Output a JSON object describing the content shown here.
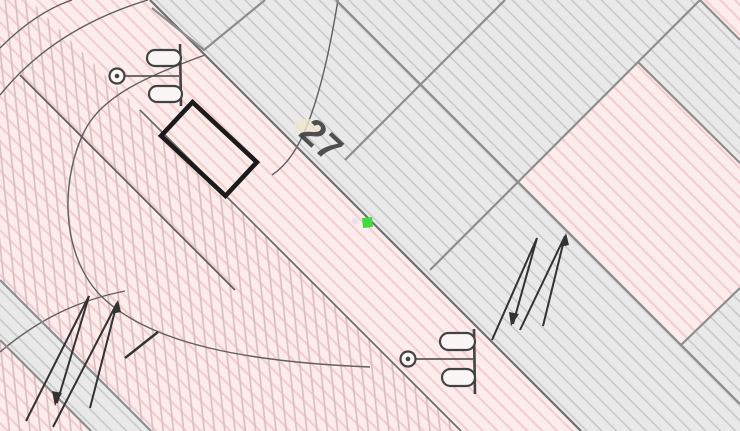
{
  "map_view": {
    "type": "cadastral-map-excerpt",
    "parcel_label": "27",
    "marker": {
      "type": "location-marker",
      "shape": "small-square",
      "color": "#3fdc3f"
    },
    "selection": {
      "type": "selected-building-outline",
      "shape": "rotated-rectangle",
      "color": "#1b1b1b"
    },
    "symbols": [
      {
        "name": "street-lamp-symbol",
        "count": 2
      },
      {
        "name": "slope-arrows-symbol",
        "count": 2
      }
    ],
    "colors": {
      "pink_bg": "#fdecec",
      "pink_hatch": "#f1cdce",
      "crosshatch_line": "#d9bec3",
      "gray_bg": "#e9e9e9",
      "gray_hatch": "#c9c9c9",
      "boundary": "#8d8d8d",
      "road_edge": "#6f6f6f",
      "curve": "#5f5f5f",
      "symbol": "#434343",
      "zigzag": "#323232",
      "label_text": "#3a3a3a",
      "prong_fill": "#faf6f6",
      "dot_lavender": "#eadcf0",
      "smudge_tan": "#f0e6cf",
      "selection_black": "#1b1b1b",
      "marker_green": "#3fdc3f"
    }
  }
}
